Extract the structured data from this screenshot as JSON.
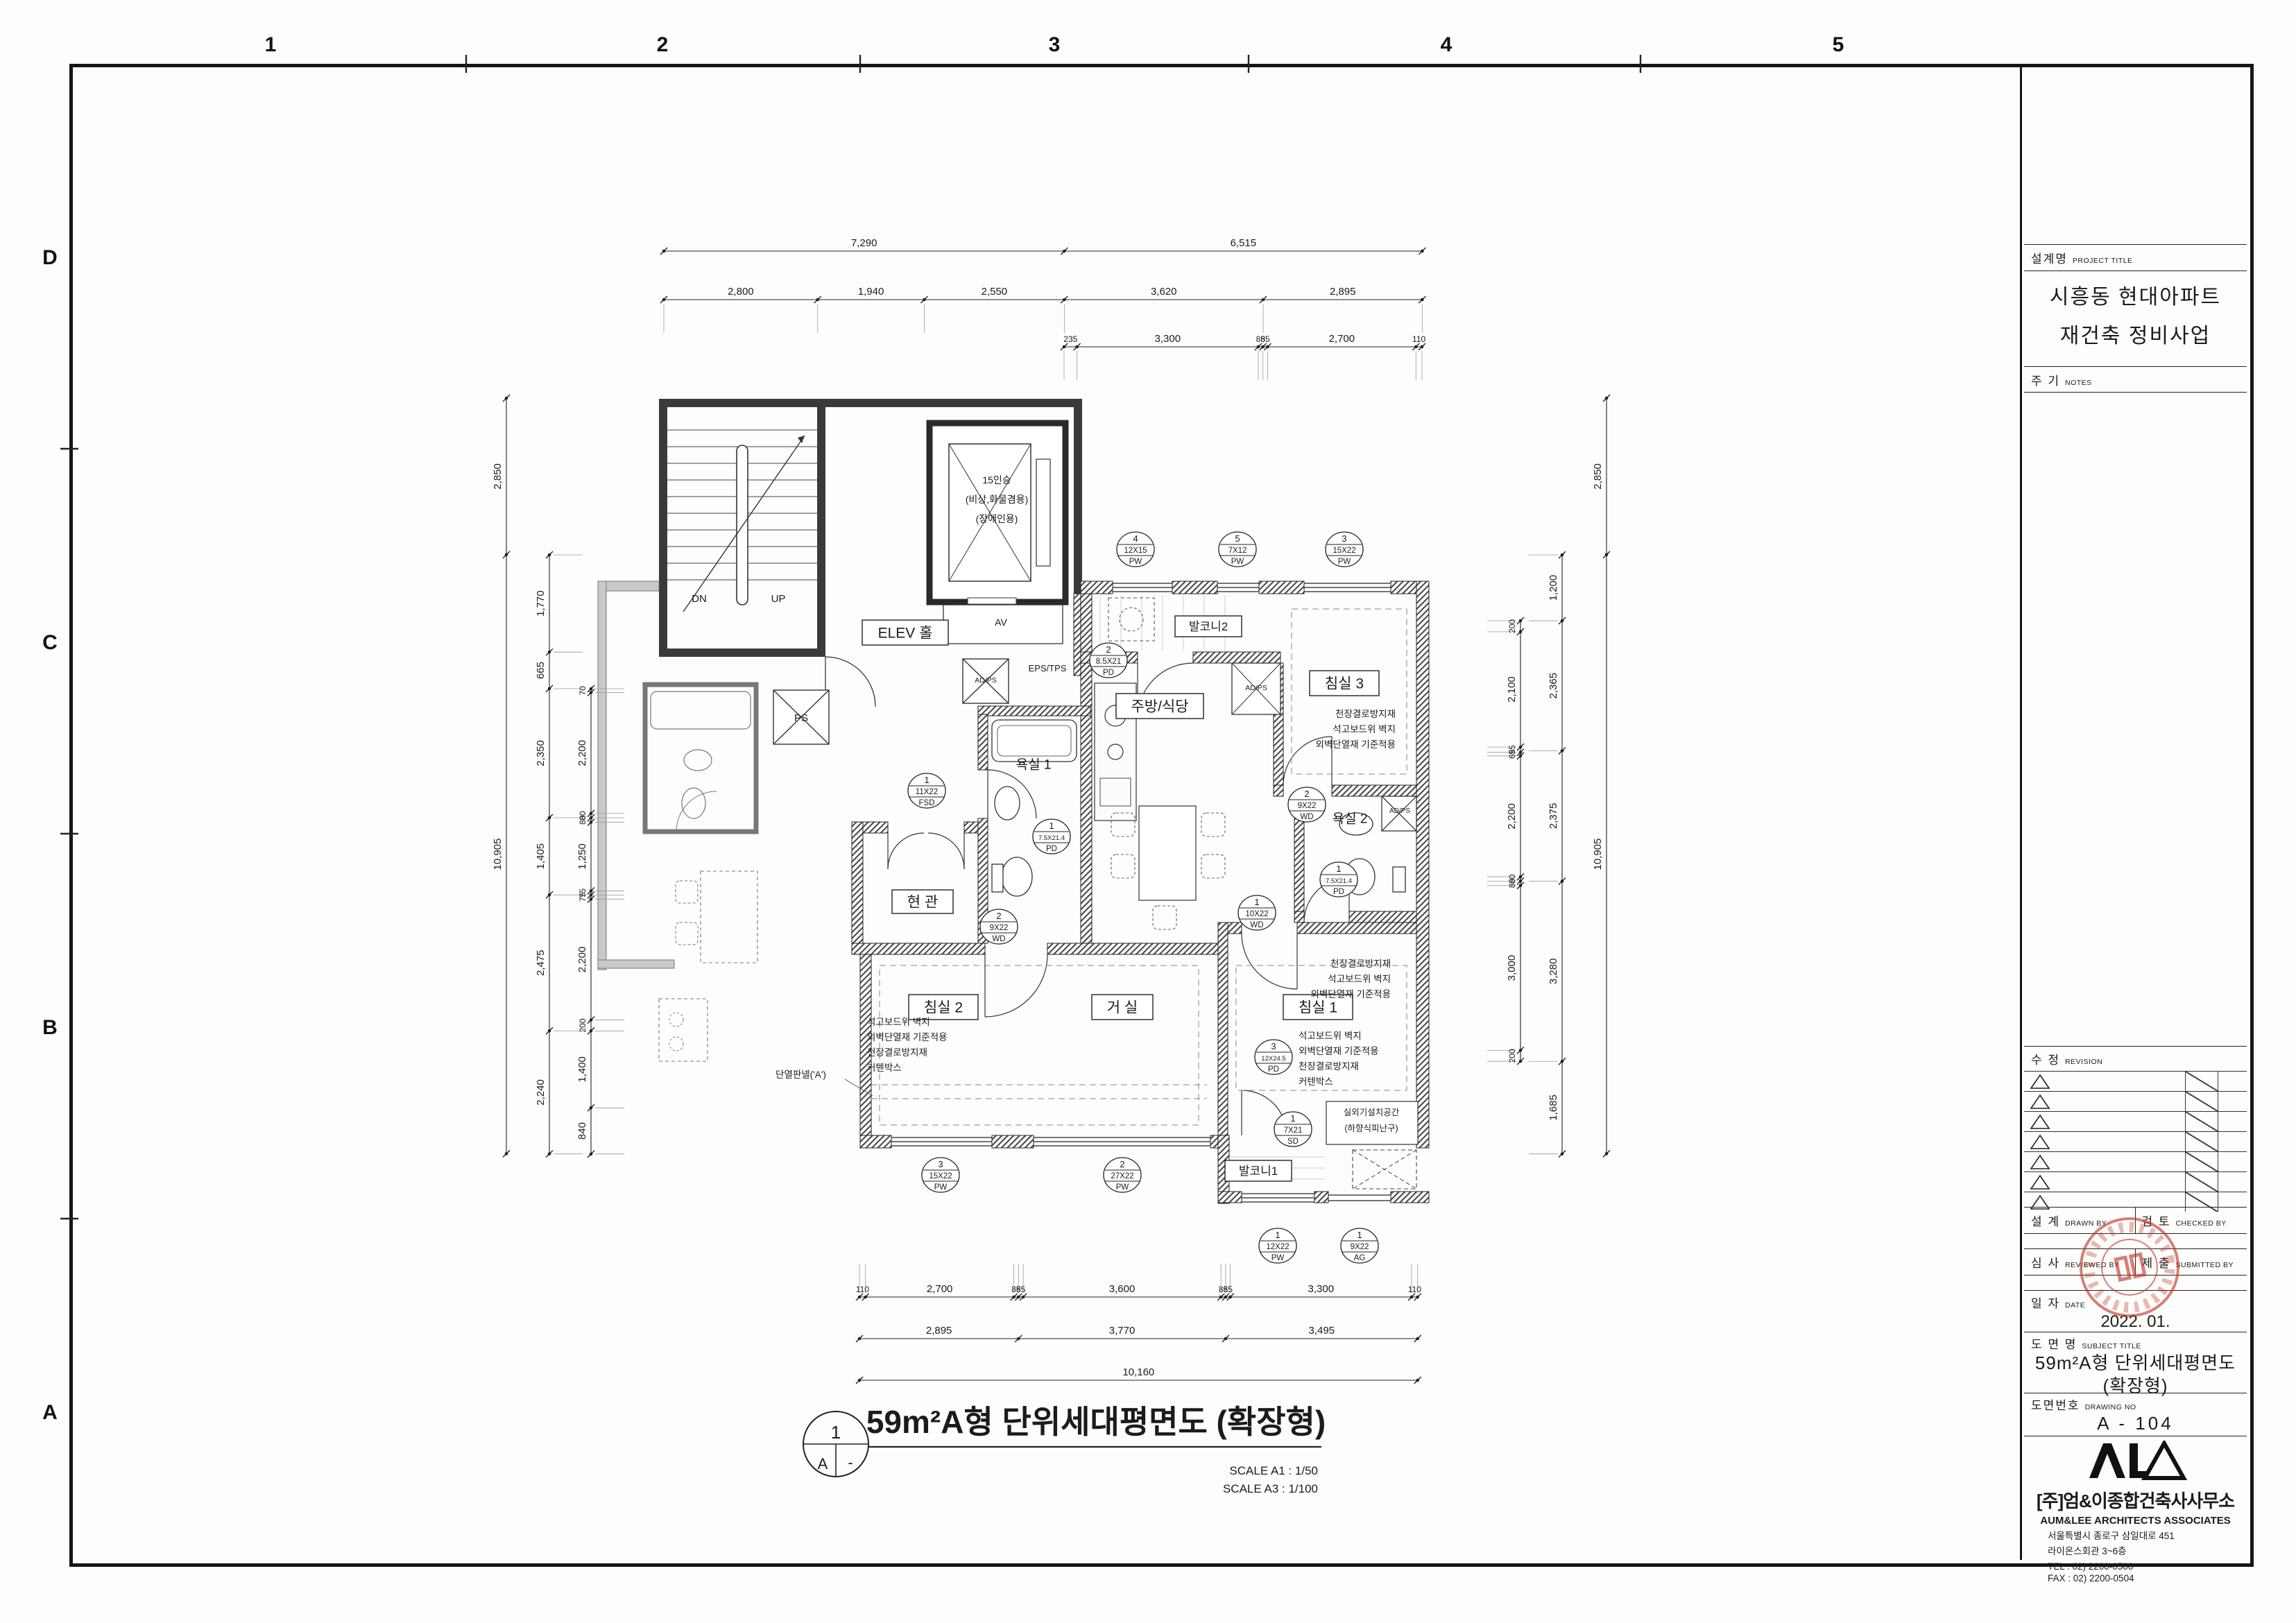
{
  "sheet": {
    "grid_cols": [
      "1",
      "2",
      "3",
      "4",
      "5"
    ],
    "grid_rows": [
      "D",
      "C",
      "B",
      "A"
    ]
  },
  "title_block": {
    "project_label": "설계명",
    "project_label_en": "PROJECT TITLE",
    "project_title_lines": [
      "시흥동 현대아파트",
      "재건축 정비사업"
    ],
    "notes_label": "주 기",
    "notes_label_en": "NOTES",
    "revision_label": "수 정",
    "revision_label_en": "REVISION",
    "revision_rows": 7,
    "drawn_label": "설 계",
    "drawn_label_en": "DRAWN BY",
    "checked_label": "검 토",
    "checked_label_en": "CHECKED BY",
    "reviewed_label": "심 사",
    "reviewed_label_en": "REVIEWED BY",
    "submitted_label": "제 출",
    "submitted_label_en": "SUBMITTED BY",
    "date_label": "일 자",
    "date_label_en": "DATE",
    "date_value": "2022. 01.",
    "subject_label": "도 면 명",
    "subject_label_en": "SUBJECT TITLE",
    "subject_lines": [
      "59m²A형 단위세대평면도",
      "(확장형)"
    ],
    "drawing_no_label": "도면번호",
    "drawing_no_label_en": "DRAWING NO",
    "drawing_no": "A  -  104",
    "company": {
      "name_kr": "[주]엄&이종합건축사사무소",
      "name_en": "AUM&LEE ARCHITECTS ASSOCIATES",
      "address_lines": [
        "서울특별시 종로구 삼일대로 451",
        "라이온스회관 3~6층"
      ],
      "tel": "TEL : 02) 2200-0500",
      "fax": "FAX : 02) 2200-0504"
    }
  },
  "drawing_title": {
    "number": "1",
    "sheet_ref": "A",
    "dash": "-",
    "title": "59m²A형 단위세대평면도 (확장형)",
    "scales": [
      "SCALE  A1 : 1/50",
      "SCALE  A3 : 1/100"
    ]
  },
  "plan": {
    "rooms": [
      {
        "label": "ELEV 홀"
      },
      {
        "label": "현 관"
      },
      {
        "label": "침실 2"
      },
      {
        "label": "거 실"
      },
      {
        "label": "침실 1"
      },
      {
        "label": "침실 3"
      },
      {
        "label": "주방/식당"
      },
      {
        "label": "욕실 1"
      },
      {
        "label": "욕실 2"
      },
      {
        "label": "발코니1"
      },
      {
        "label": "발코니2"
      }
    ],
    "small_labels": [
      "DN",
      "UP",
      "PS",
      "AV",
      "EPS/TPS",
      "AD/PS",
      "AD/PS",
      "AD/PS"
    ],
    "elevator_lines": [
      "15인승",
      "(비상,화물겸용)",
      "(장애인용)"
    ],
    "ac_room_lines": [
      "실외기설치공간",
      "(하향식피난구)"
    ],
    "insulation_note": "단열판넬('A')",
    "notes": [
      {
        "lines": [
          "천장결로방지재",
          "석고보드위 벽지",
          "외벽단열재 기준적용"
        ]
      },
      {
        "lines": [
          "천장결로방지재",
          "석고보드위 벽지",
          "외벽단열재 기준적용"
        ]
      },
      {
        "lines": [
          "석고보드위 벽지",
          "외벽단열재 기준적용",
          "천장결로방지재",
          "커텐박스"
        ]
      },
      {
        "lines": [
          "석고보드위 벽지",
          "외벽단열재 기준적용",
          "천장결로방지재",
          "커텐박스"
        ]
      },
      {
        "lines": [
          "단열판넬('A')"
        ]
      }
    ],
    "tags": [
      {
        "no": "4",
        "size": "12X15",
        "mark": "PW"
      },
      {
        "no": "5",
        "size": "7X12",
        "mark": "PW"
      },
      {
        "no": "3",
        "size": "15X22",
        "mark": "PW"
      },
      {
        "no": "2",
        "size": "8.5X21",
        "mark": "PD"
      },
      {
        "no": "2",
        "size": "9X22",
        "mark": "WD"
      },
      {
        "no": "1",
        "size": "11X22",
        "mark": "FSD"
      },
      {
        "no": "1",
        "size": "7.5X21.4",
        "mark": "PD"
      },
      {
        "no": "2",
        "size": "9X22",
        "mark": "WD"
      },
      {
        "no": "1",
        "size": "7.5X21.4",
        "mark": "PD"
      },
      {
        "no": "1",
        "size": "10X22",
        "mark": "WD"
      },
      {
        "no": "3",
        "size": "12X24.5",
        "mark": "PD"
      },
      {
        "no": "1",
        "size": "7X21",
        "mark": "SD"
      },
      {
        "no": "3",
        "size": "15X22",
        "mark": "PW"
      },
      {
        "no": "2",
        "size": "27X22",
        "mark": "PW"
      },
      {
        "no": "1",
        "size": "12X22",
        "mark": "PW"
      },
      {
        "no": "1",
        "size": "9X22",
        "mark": "AG"
      }
    ]
  },
  "dimensions": {
    "top1": [
      "7,290",
      "6,515"
    ],
    "top2": [
      "2,800",
      "1,940",
      "2,550",
      "3,620",
      "2,895"
    ],
    "top3": [
      "235",
      "3,300",
      "85",
      "85",
      "2,700",
      "110"
    ],
    "bottom1": [
      "110",
      "2,700",
      "85",
      "85",
      "3,600",
      "85",
      "85",
      "3,300",
      "110"
    ],
    "bottom2": [
      "2,895",
      "3,770",
      "3,495"
    ],
    "bottom3": [
      "10,160"
    ],
    "left_outer": [
      "2,850",
      "10,905"
    ],
    "left_mid": [
      "1,770",
      "665",
      "2,350",
      "1,405",
      "2,475",
      "2,240"
    ],
    "left_inner": [
      "70",
      "2,200",
      "80",
      "80",
      "1,250",
      "75",
      "75",
      "2,200",
      "200",
      "1,400",
      "840"
    ],
    "right_outer": [
      "2,850",
      "10,905"
    ],
    "right_mid": [
      "1,200",
      "2,365",
      "2,375",
      "3,280",
      "1,685"
    ],
    "right_inner": [
      "200",
      "2,100",
      "95",
      "65",
      "2,200",
      "80",
      "80",
      "3,000",
      "200"
    ]
  }
}
